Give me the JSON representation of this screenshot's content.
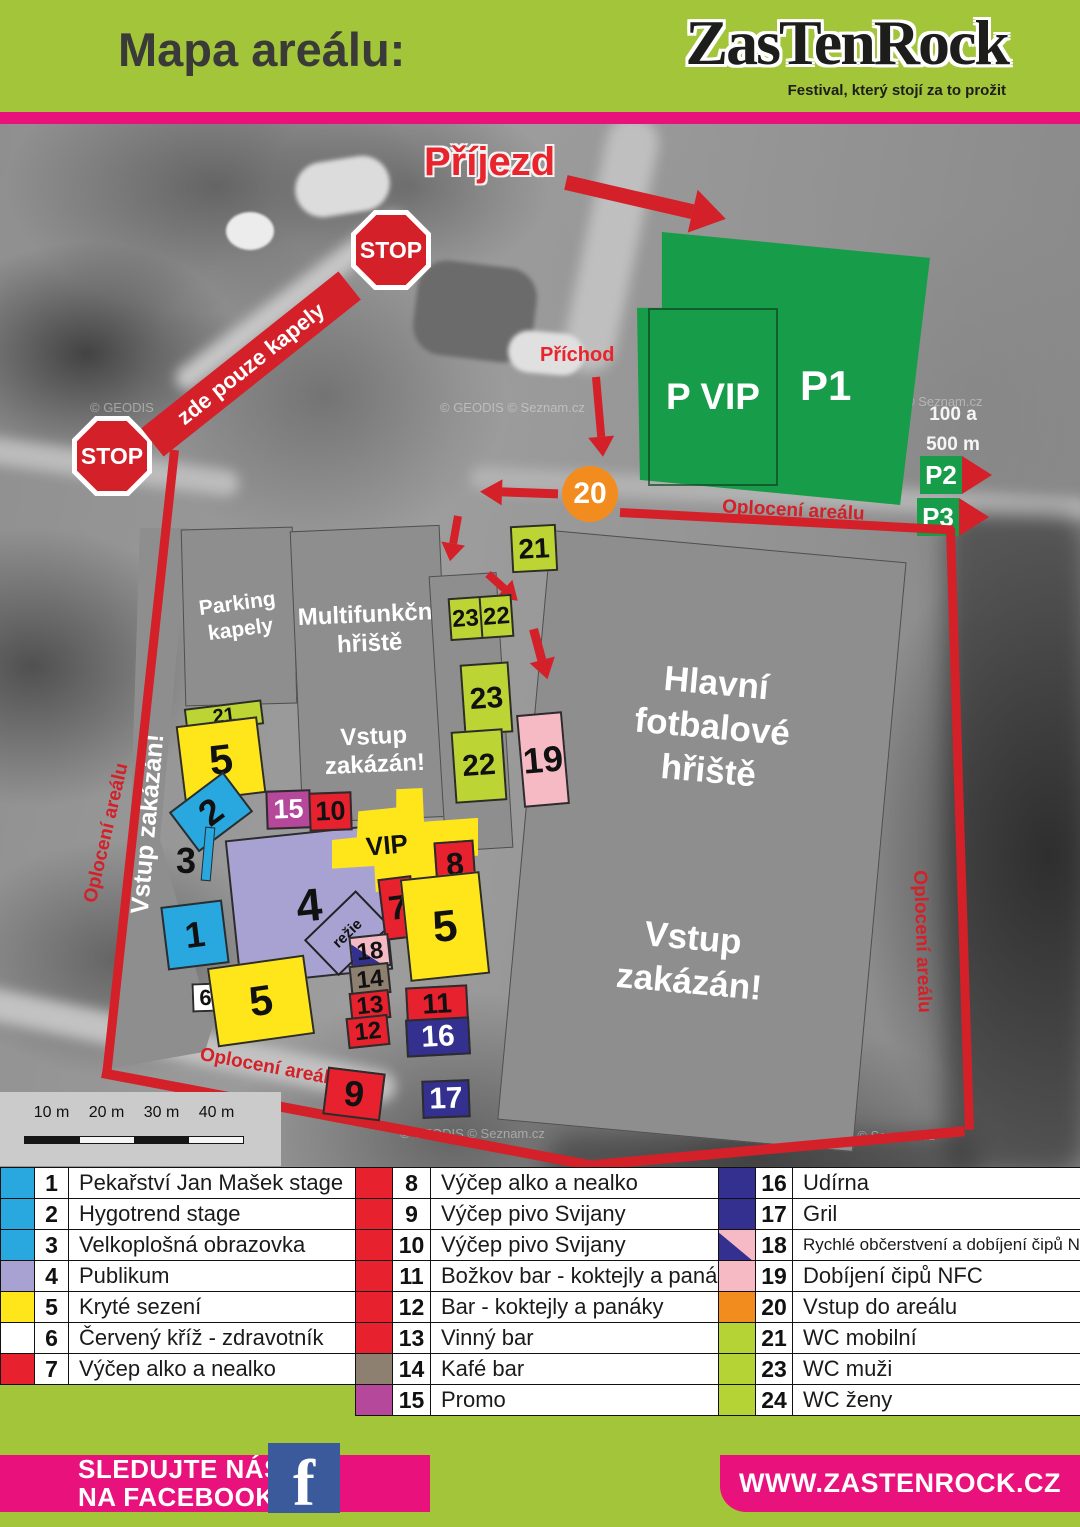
{
  "header": {
    "title": "Mapa areálu:",
    "logo": "ZasTenRock",
    "tagline": "Festival, který stojí za to prožit"
  },
  "date": "23.8.2025",
  "colors": {
    "brand_green": "#a3c53a",
    "brand_magenta": "#e9117c",
    "fence_red": "#d42028",
    "parking_green": "#179c49"
  },
  "map": {
    "arrival_label": "Příjezd",
    "approach_label": "Příchod",
    "stop_label": "STOP",
    "bands_only_label": "zde pouze kapely",
    "fence_label": "Oplocení areálu",
    "no_entry_label": "Vstup zakázán!",
    "parking_vip_label": "P VIP",
    "parking_p1": "P1",
    "parking_p2": "P2",
    "parking_p3": "P3",
    "distance_line1": "100 a",
    "distance_line2": "500 m",
    "band_parking_label": "Parking kapely",
    "multi_pitch_label": "Multifunkční hřiště",
    "main_pitch_label": "Hlavní fotbalové hřiště",
    "vip_label": "VIP",
    "rezie_label": "režie",
    "watermark_geodis": "© GEODIS",
    "watermark_seznam": "© Seznam.cz",
    "watermark_combo": "© GEODIS  © Seznam.cz",
    "markers": {
      "m1": "1",
      "m2": "2",
      "m3": "3",
      "m4": "4",
      "m5": "5",
      "m6": "6",
      "m7": "7",
      "m8": "8",
      "m9": "9",
      "m10": "10",
      "m11": "11",
      "m12": "12",
      "m13": "13",
      "m14": "14",
      "m15": "15",
      "m16": "16",
      "m17": "17",
      "m18": "18",
      "m19": "19",
      "m20": "20",
      "m21": "21",
      "m22": "22",
      "m23": "23"
    }
  },
  "scale": {
    "ticks": [
      "10 m",
      "20 m",
      "30 m",
      "40 m"
    ]
  },
  "legend": {
    "columns": [
      [
        {
          "num": "1",
          "label": "Pekařství Jan Mašek stage",
          "color": "#29a8e0"
        },
        {
          "num": "2",
          "label": "Hygotrend stage",
          "color": "#29a8e0"
        },
        {
          "num": "3",
          "label": "Velkoplošná obrazovka",
          "color": "#29a8e0"
        },
        {
          "num": "4",
          "label": "Publikum",
          "color": "#a8a2d3"
        },
        {
          "num": "5",
          "label": "Kryté sezení",
          "color": "#ffe61a"
        },
        {
          "num": "6",
          "label": "Červený kříž - zdravotník",
          "color": "#ffffff"
        },
        {
          "num": "7",
          "label": "Výčep alko a nealko",
          "color": "#e8212e"
        }
      ],
      [
        {
          "num": "8",
          "label": "Výčep alko a nealko",
          "color": "#e8212e"
        },
        {
          "num": "9",
          "label": "Výčep pivo Svijany",
          "color": "#e8212e"
        },
        {
          "num": "10",
          "label": "Výčep pivo Svijany",
          "color": "#e8212e"
        },
        {
          "num": "11",
          "label": "Božkov bar - koktejly a panáky",
          "color": "#e8212e"
        },
        {
          "num": "12",
          "label": "Bar - koktejly a panáky",
          "color": "#e8212e"
        },
        {
          "num": "13",
          "label": "Vinný bar",
          "color": "#e8212e"
        },
        {
          "num": "14",
          "label": "Kafé bar",
          "color": "#8d8070"
        },
        {
          "num": "15",
          "label": "Promo",
          "color": "#b5489a"
        }
      ],
      [
        {
          "num": "16",
          "label": "Udírna",
          "color": "#333090"
        },
        {
          "num": "17",
          "label": "Gril",
          "color": "#333090"
        },
        {
          "num": "18",
          "label": "Rychlé občerstvení a dobíjení čipů NFC",
          "color": "#333090",
          "color2": "#f6bac5",
          "small": true
        },
        {
          "num": "19",
          "label": "Dobíjení čipů NFC",
          "color": "#f6bac5"
        },
        {
          "num": "20",
          "label": "Vstup do areálu",
          "color": "#f28c1e"
        },
        {
          "num": "21",
          "label": "WC mobilní",
          "color": "#b5d334"
        },
        {
          "num": "23",
          "label": "WC muži",
          "color": "#b5d334"
        },
        {
          "num": "24",
          "label": "WC ženy",
          "color": "#b5d334"
        }
      ]
    ]
  },
  "footer": {
    "follow_line1": "SLEDUJTE NÁS",
    "follow_line2": "NA FACEBOOKU",
    "facebook_icon": "f",
    "website": "WWW.ZASTENROCK.CZ"
  }
}
